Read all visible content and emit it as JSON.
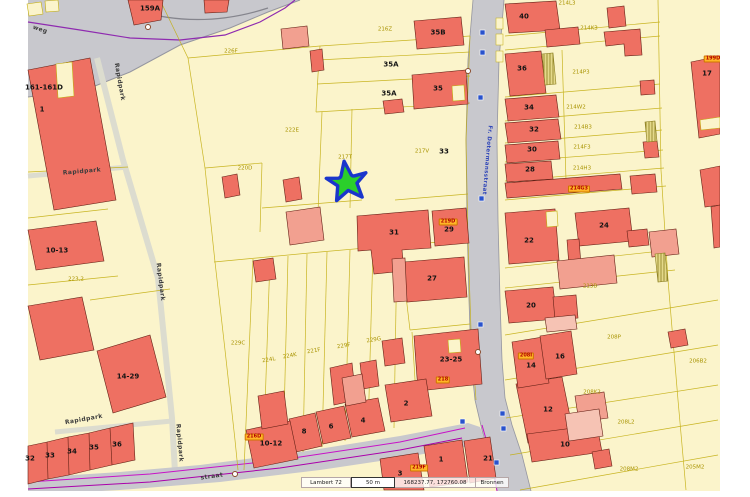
{
  "status": {
    "crs": "Lambert 72",
    "scale": "50 m",
    "coords": "168237.77, 172760.08",
    "sources": "Bronnen"
  },
  "colors": {
    "parcel_fill": "#fbf4cb",
    "parcel_line": "#c3ae10",
    "building_fill": "#ee7062",
    "building_light": "#f2a090",
    "road_fill": "#c8c8cd",
    "highlight_tag": "#ffb627",
    "marker_star_fill": "#2bcf2b",
    "marker_star_stroke": "#1a35cc",
    "utility_line": "#c713c7",
    "sign_icon": "#2952cc"
  },
  "labels": [
    {
      "kind": "street",
      "text": "weg",
      "x": 40,
      "y": 30,
      "r": 18
    },
    {
      "kind": "street",
      "text": "Rapidpark",
      "x": 119,
      "y": 82,
      "r": 80
    },
    {
      "kind": "street",
      "text": "Rapidpark",
      "x": 82,
      "y": 172,
      "r": -5
    },
    {
      "kind": "street",
      "text": "Rapidpark",
      "x": 160,
      "y": 282,
      "r": 83
    },
    {
      "kind": "street",
      "text": "Rapidpark",
      "x": 84,
      "y": 420,
      "r": -10
    },
    {
      "kind": "street",
      "text": "Rapidpark",
      "x": 179,
      "y": 443,
      "r": 85
    },
    {
      "kind": "streetblue",
      "text": "Fr. Dotermansstraat",
      "x": 486,
      "y": 160,
      "r": 95
    },
    {
      "kind": "street",
      "text": "straat",
      "x": 212,
      "y": 477,
      "r": -8
    },
    {
      "kind": "house",
      "text": "159A",
      "x": 150,
      "y": 9,
      "r": 0
    },
    {
      "kind": "house",
      "text": "161-161D",
      "x": 44,
      "y": 88,
      "r": 0
    },
    {
      "kind": "house",
      "text": "1",
      "x": 42,
      "y": 110,
      "r": 0
    },
    {
      "kind": "house",
      "text": "10-13",
      "x": 57,
      "y": 251,
      "r": 0
    },
    {
      "kind": "house",
      "text": "14-29",
      "x": 128,
      "y": 377,
      "r": 0
    },
    {
      "kind": "house",
      "text": "32",
      "x": 30,
      "y": 459,
      "r": 0
    },
    {
      "kind": "house",
      "text": "33",
      "x": 50,
      "y": 456,
      "r": 0
    },
    {
      "kind": "house",
      "text": "34",
      "x": 72,
      "y": 452,
      "r": 0
    },
    {
      "kind": "house",
      "text": "35",
      "x": 94,
      "y": 448,
      "r": 0
    },
    {
      "kind": "house",
      "text": "36",
      "x": 117,
      "y": 445,
      "r": 0
    },
    {
      "kind": "house",
      "text": "35B",
      "x": 438,
      "y": 33,
      "r": 0
    },
    {
      "kind": "house",
      "text": "35A",
      "x": 391,
      "y": 65,
      "r": 0
    },
    {
      "kind": "house",
      "text": "35A",
      "x": 389,
      "y": 94,
      "r": 0
    },
    {
      "kind": "house",
      "text": "35",
      "x": 438,
      "y": 89,
      "r": 0
    },
    {
      "kind": "house",
      "text": "33",
      "x": 444,
      "y": 152,
      "r": 0
    },
    {
      "kind": "house",
      "text": "31",
      "x": 394,
      "y": 233,
      "r": 0
    },
    {
      "kind": "house",
      "text": "29",
      "x": 449,
      "y": 230,
      "r": 0
    },
    {
      "kind": "house",
      "text": "27",
      "x": 432,
      "y": 279,
      "r": 0
    },
    {
      "kind": "house",
      "text": "40",
      "x": 524,
      "y": 17,
      "r": 0
    },
    {
      "kind": "house",
      "text": "36",
      "x": 522,
      "y": 69,
      "r": 0
    },
    {
      "kind": "house",
      "text": "34",
      "x": 529,
      "y": 108,
      "r": 0
    },
    {
      "kind": "house",
      "text": "32",
      "x": 534,
      "y": 130,
      "r": 0
    },
    {
      "kind": "house",
      "text": "30",
      "x": 532,
      "y": 150,
      "r": 0
    },
    {
      "kind": "house",
      "text": "28",
      "x": 530,
      "y": 170,
      "r": 0
    },
    {
      "kind": "house",
      "text": "22",
      "x": 529,
      "y": 241,
      "r": 0
    },
    {
      "kind": "house",
      "text": "24",
      "x": 604,
      "y": 226,
      "r": 0
    },
    {
      "kind": "house",
      "text": "20",
      "x": 531,
      "y": 306,
      "r": 0
    },
    {
      "kind": "house",
      "text": "17",
      "x": 707,
      "y": 74,
      "r": 0
    },
    {
      "kind": "house",
      "text": "23-25",
      "x": 451,
      "y": 360,
      "r": 0
    },
    {
      "kind": "house",
      "text": "2",
      "x": 406,
      "y": 404,
      "r": 0
    },
    {
      "kind": "house",
      "text": "4",
      "x": 363,
      "y": 421,
      "r": 0
    },
    {
      "kind": "house",
      "text": "6",
      "x": 331,
      "y": 427,
      "r": 0
    },
    {
      "kind": "house",
      "text": "8",
      "x": 304,
      "y": 432,
      "r": 0
    },
    {
      "kind": "house",
      "text": "10-12",
      "x": 271,
      "y": 444,
      "r": 0
    },
    {
      "kind": "house",
      "text": "3",
      "x": 400,
      "y": 474,
      "r": 0
    },
    {
      "kind": "house",
      "text": "1",
      "x": 441,
      "y": 460,
      "r": 0
    },
    {
      "kind": "house",
      "text": "21",
      "x": 488,
      "y": 459,
      "r": 0
    },
    {
      "kind": "house",
      "text": "16",
      "x": 560,
      "y": 357,
      "r": 0
    },
    {
      "kind": "house",
      "text": "14",
      "x": 531,
      "y": 366,
      "r": 0
    },
    {
      "kind": "house",
      "text": "12",
      "x": 548,
      "y": 410,
      "r": 0
    },
    {
      "kind": "house",
      "text": "10",
      "x": 565,
      "y": 445,
      "r": 0
    },
    {
      "kind": "parcel",
      "text": "226F",
      "x": 231,
      "y": 52,
      "r": 0
    },
    {
      "kind": "parcel",
      "text": "216Z",
      "x": 385,
      "y": 30,
      "r": 0
    },
    {
      "kind": "parcel",
      "text": "222E",
      "x": 292,
      "y": 131,
      "r": 0
    },
    {
      "kind": "parcel",
      "text": "220D",
      "x": 245,
      "y": 169,
      "r": 0
    },
    {
      "kind": "parcel",
      "text": "217T",
      "x": 345,
      "y": 158,
      "r": 0
    },
    {
      "kind": "parcel",
      "text": "217V",
      "x": 422,
      "y": 152,
      "r": 0
    },
    {
      "kind": "parcel",
      "text": "223,2",
      "x": 76,
      "y": 280,
      "r": 0
    },
    {
      "kind": "parcel",
      "text": "229C",
      "x": 238,
      "y": 344,
      "r": 0
    },
    {
      "kind": "parcel",
      "text": "224L",
      "x": 269,
      "y": 361,
      "r": -10
    },
    {
      "kind": "parcel",
      "text": "224K",
      "x": 290,
      "y": 357,
      "r": -10
    },
    {
      "kind": "parcel",
      "text": "221F",
      "x": 314,
      "y": 352,
      "r": -10
    },
    {
      "kind": "parcel",
      "text": "229F",
      "x": 344,
      "y": 347,
      "r": -10
    },
    {
      "kind": "parcel",
      "text": "229G",
      "x": 374,
      "y": 341,
      "r": -10
    },
    {
      "kind": "parcel",
      "text": "214L3",
      "x": 567,
      "y": 4,
      "r": 0
    },
    {
      "kind": "parcel",
      "text": "214K3",
      "x": 589,
      "y": 29,
      "r": 0
    },
    {
      "kind": "parcel",
      "text": "214P3",
      "x": 581,
      "y": 73,
      "r": 0
    },
    {
      "kind": "parcel",
      "text": "214W2",
      "x": 576,
      "y": 108,
      "r": 0
    },
    {
      "kind": "parcel",
      "text": "214B3",
      "x": 583,
      "y": 128,
      "r": 0
    },
    {
      "kind": "parcel",
      "text": "214F3",
      "x": 582,
      "y": 148,
      "r": 0
    },
    {
      "kind": "parcel",
      "text": "214H3",
      "x": 582,
      "y": 169,
      "r": 0
    },
    {
      "kind": "parcel",
      "text": "213B",
      "x": 590,
      "y": 287,
      "r": 0
    },
    {
      "kind": "parcel",
      "text": "208P",
      "x": 614,
      "y": 338,
      "r": 0
    },
    {
      "kind": "parcel",
      "text": "208K2",
      "x": 592,
      "y": 393,
      "r": 0
    },
    {
      "kind": "parcel",
      "text": "208L2",
      "x": 626,
      "y": 423,
      "r": 0
    },
    {
      "kind": "parcel",
      "text": "208M2",
      "x": 629,
      "y": 470,
      "r": 0
    },
    {
      "kind": "parcel",
      "text": "206B2",
      "x": 698,
      "y": 362,
      "r": 0
    },
    {
      "kind": "parcel",
      "text": "205M2",
      "x": 695,
      "y": 468,
      "r": 0
    },
    {
      "kind": "tag",
      "text": "219D",
      "x": 448,
      "y": 222,
      "r": 0
    },
    {
      "kind": "tag",
      "text": "214G3",
      "x": 579,
      "y": 189,
      "r": 0
    },
    {
      "kind": "tag",
      "text": "218",
      "x": 443,
      "y": 380,
      "r": 0
    },
    {
      "kind": "tag",
      "text": "216D",
      "x": 254,
      "y": 437,
      "r": 0
    },
    {
      "kind": "tag",
      "text": "219F",
      "x": 419,
      "y": 468,
      "r": 0
    },
    {
      "kind": "tag",
      "text": "208I",
      "x": 526,
      "y": 356,
      "r": 0
    },
    {
      "kind": "tag",
      "text": "199D",
      "x": 713,
      "y": 59,
      "r": 0
    }
  ]
}
